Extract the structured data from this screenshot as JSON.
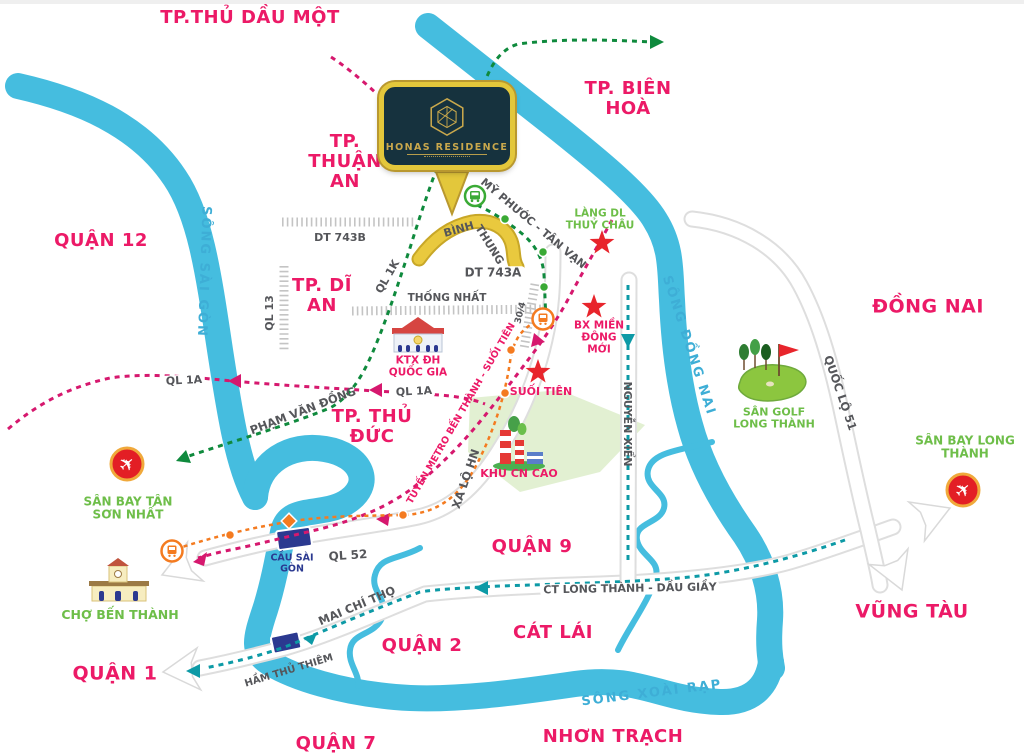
{
  "project": {
    "name": "HONAS RESIDENCE"
  },
  "labels": {
    "cities": {
      "thuDauMot": "TP.THỦ DẦU MỘT",
      "bienHoa": "TP. BIÊN HOÀ",
      "quan12": "QUẬN 12",
      "thuanAn": "TP. THUẬN AN",
      "diAn": "TP. DĨ AN",
      "dongNai": "ĐỒNG NAI",
      "thuDuc": "TP. THỦ ĐỨC",
      "quan9": "QUẬN 9",
      "quan2": "QUẬN 2",
      "quan1": "QUẬN 1",
      "quan7": "QUẬN 7",
      "catLai": "CÁT LÁI",
      "nhonTrach": "NHƠN TRẠCH",
      "vungTau": "VŨNG TÀU"
    },
    "rivers": {
      "saiGon": "SÔNG SÀI GÒN",
      "dongNai": "SÔNG ĐỒNG NAI",
      "xoaiRap": "SÔNG XOÀI RẠP"
    },
    "roads": {
      "dt743b": "DT 743B",
      "dt743a": "DT 743A",
      "thongNhat": "THỐNG NHẤT",
      "ql13": "QL 13",
      "ql1k": "QL 1K",
      "binhThung1": "BÌNH",
      "binhThung2": "THUNG",
      "myPhuoc": "MỸ PHƯỚC - TÂN VẠN",
      "ql1a": "QL 1A",
      "phamVanDong": "PHẠM VĂN ĐỒNG",
      "ql52": "QL 52",
      "xaLoHN": "XA LỘ HN",
      "nguyenXien": "NGUYỄN XIỂN",
      "maiChiTho": "MAI CHÍ THỌ",
      "hamThuThiem": "HẦM THỦ THIÊM",
      "ctLongThanh": "CT LONG THÀNH - DẦU GIẦY",
      "quocLo51": "QUỐC LỘ 51",
      "metro": "TUYẾN METRO BẾN THÀNH - SUỐI TIÊN",
      "road304": "30/4"
    },
    "pois": {
      "langDL": "LÀNG DL THUỶ CHÂU",
      "bxMienDong": "BX MIỀN ĐÔNG MỚI",
      "ktx": "KTX ĐH QUỐC GIA",
      "suoiTien": "SUỐI TIÊN",
      "khuCNCao": "KHU CN CAO",
      "sanGolf": "SÂN GOLF LONG THÀNH",
      "sanBayLT": "SÂN BAY LONG THÀNH",
      "sanBayTSN": "SÂN BAY TÂN SƠN NHẤT",
      "choBenThanh": "CHỢ BẾN THÀNH",
      "cauSaiGon": "CẦU SÀI GÒN"
    }
  },
  "icons": {
    "project": "honas-hexagon-icon",
    "busStop": "bus-stop-icon",
    "metroStation": "train-station-icon",
    "airport": "airplane-icon",
    "market": "market-building-icon",
    "university": "university-building-icon",
    "hitechPark": "factory-icon",
    "golfCourse": "golf-course-icon",
    "landmark": "star-icon",
    "bridge": "bridge-icon",
    "tunnel": "tunnel-icon"
  },
  "colors": {
    "pink": "#ec1a67",
    "crimson": "#d6186e",
    "river": "#45bddf",
    "riverText": "#3eaed6",
    "green": "#6ebe49",
    "darkGreen": "#0f8a3d",
    "teal": "#0d9aa6",
    "orange": "#f47b20",
    "gray": "#55565a",
    "navy": "#2b3990",
    "red": "#e8252c",
    "yellowRoad": "#e9c93e",
    "yellowRoadEdge": "#c8a728",
    "gold": "#c9a84c",
    "goldBright": "#e3c73b",
    "logoNavy": "#16323e",
    "hatch": "#c4c4c4",
    "roadEdge": "#dedede",
    "zone": "#ddedca"
  }
}
